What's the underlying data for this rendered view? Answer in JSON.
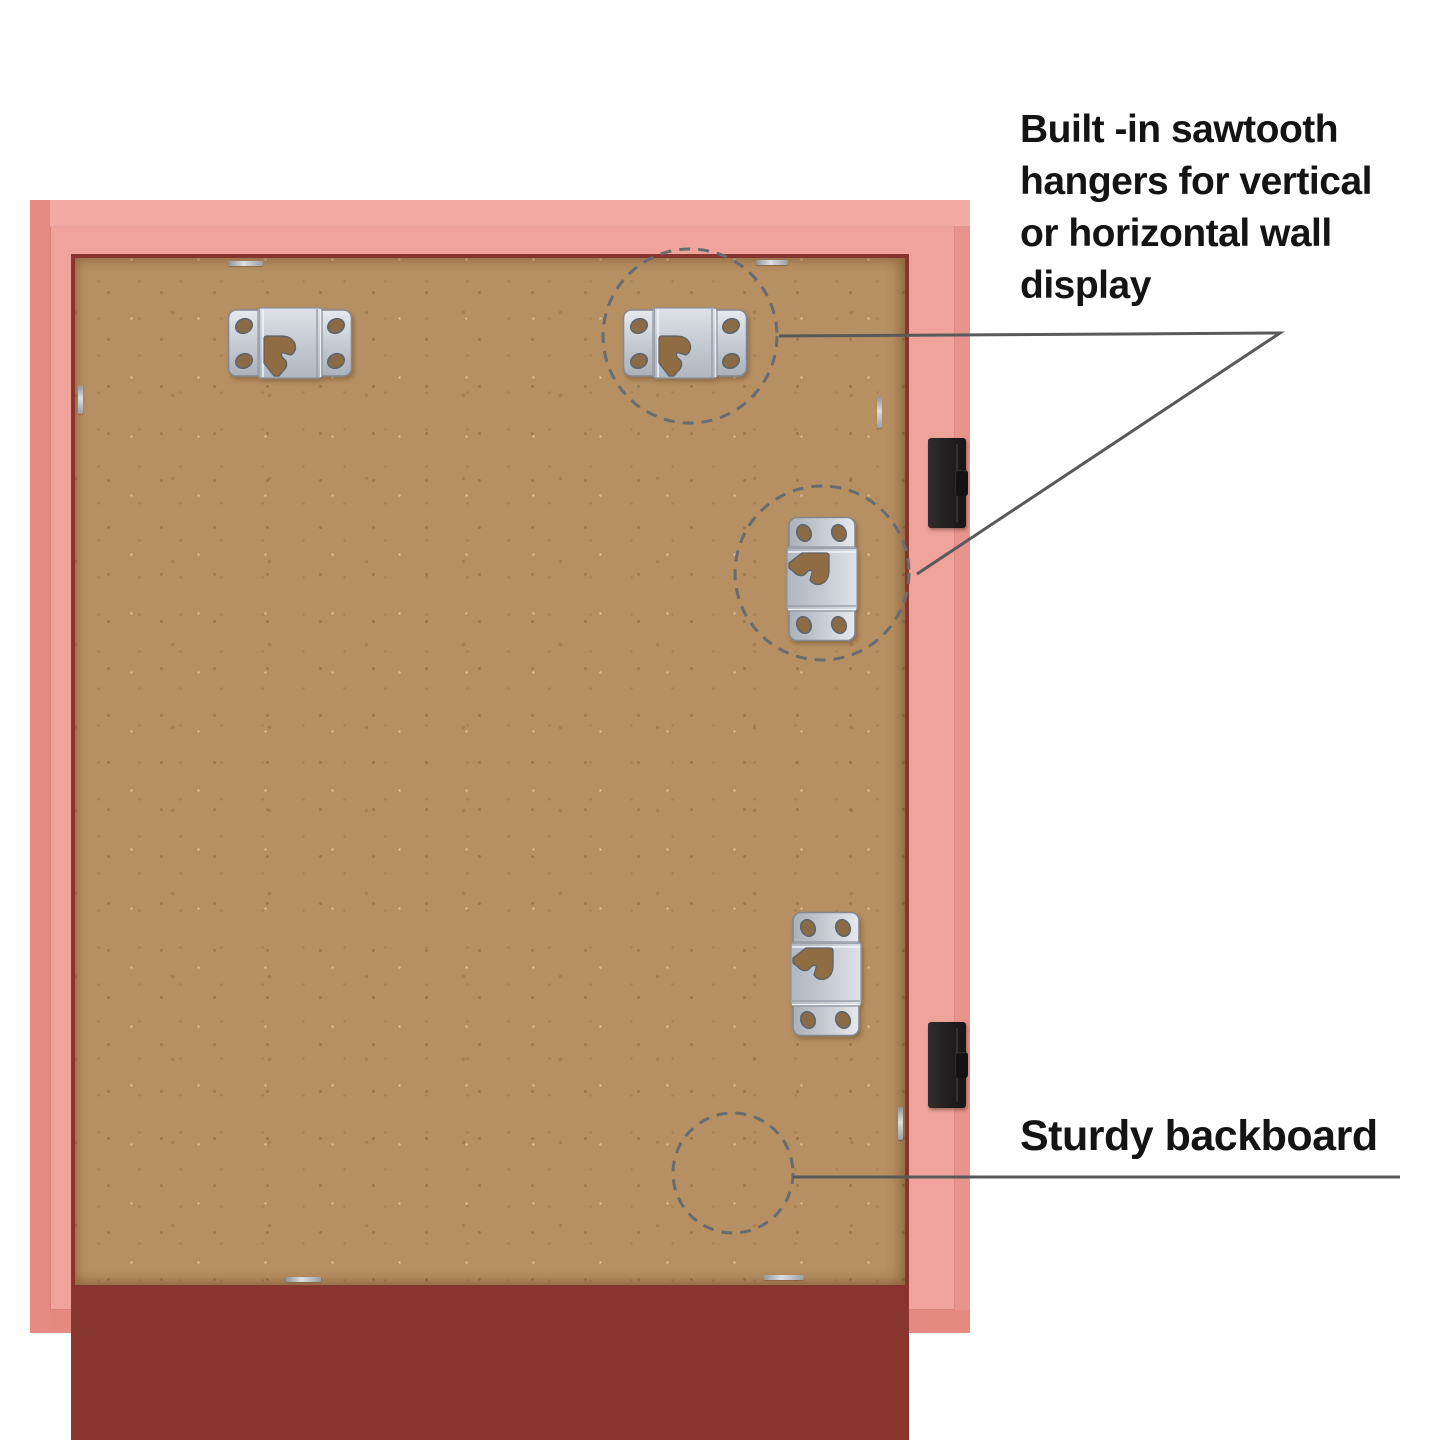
{
  "image_type": "annotated product photo: back of a pink picture frame",
  "annotations": {
    "sawtooth_hangers": {
      "lines": [
        "Built -in sawtooth",
        "hangers for vertical",
        "or horizontal wall",
        "display"
      ]
    },
    "backboard": {
      "label": "Sturdy backboard"
    }
  },
  "colors": {
    "background": "#ffffff",
    "frame_pink": "#efa39b",
    "frame_pink_dark": "#e58b82",
    "inner_shadow_maroon": "#87352d",
    "backboard_tan": "#b69062",
    "metal_silver": "#c9ced6",
    "clip_black": "#211e1f",
    "callout_line_gray": "#58595b",
    "text_color": "#141414"
  },
  "components": {
    "hangers": [
      {
        "type": "sawtooth-hanger",
        "orientation": "horizontal",
        "position": "top-left"
      },
      {
        "type": "sawtooth-hanger",
        "orientation": "horizontal",
        "position": "top-right",
        "highlighted": true
      },
      {
        "type": "sawtooth-hanger",
        "orientation": "vertical",
        "position": "middle-right",
        "highlighted": true
      },
      {
        "type": "sawtooth-hanger",
        "orientation": "vertical",
        "position": "lower-right"
      }
    ],
    "clips": [
      {
        "type": "retainer-clip",
        "position": "right-upper"
      },
      {
        "type": "retainer-clip",
        "position": "right-lower"
      }
    ],
    "staples_count": 7,
    "highlight_circles": [
      {
        "target": "top-right-hanger"
      },
      {
        "target": "middle-right-hanger"
      },
      {
        "target": "backboard-surface"
      }
    ]
  }
}
